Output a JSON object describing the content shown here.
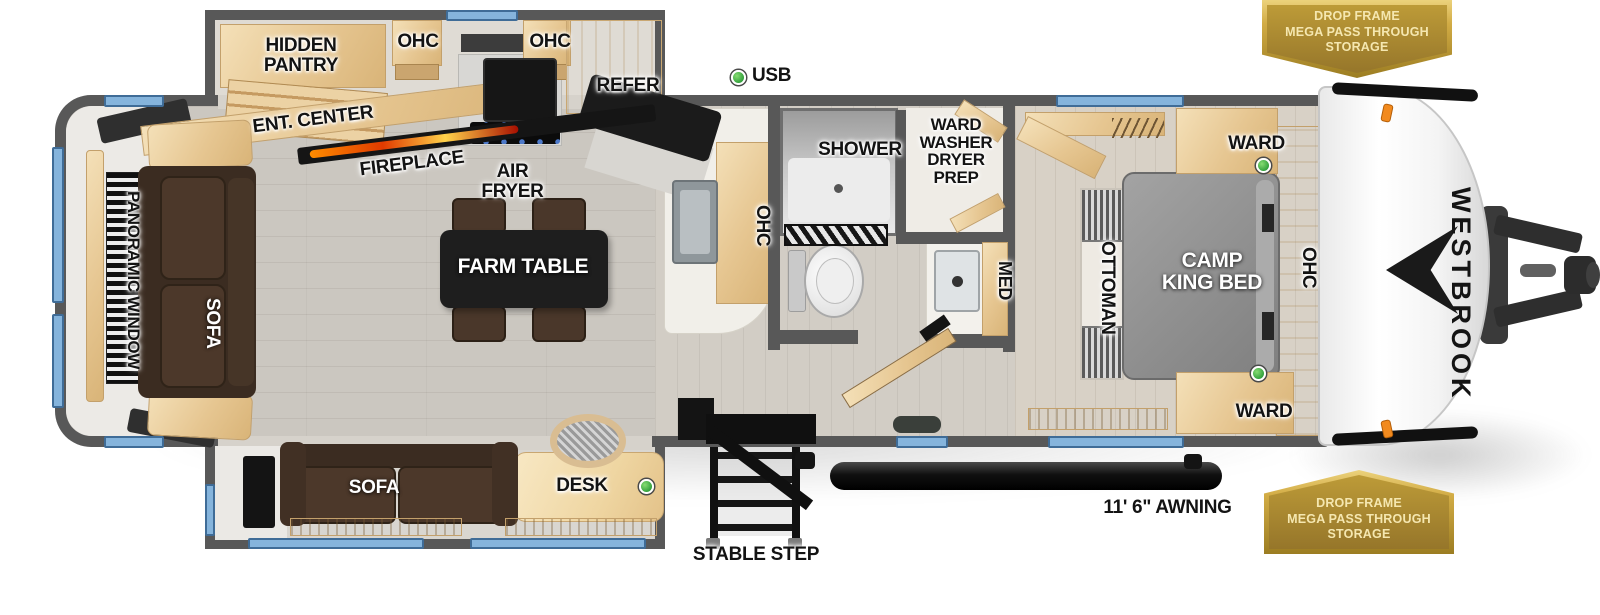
{
  "brand": {
    "name": "WESTBROOK"
  },
  "badges": {
    "top_right": {
      "lines": [
        "DROP FRAME",
        "MEGA PASS THROUGH",
        "STORAGE"
      ]
    },
    "bottom_right": {
      "lines": [
        "DROP FRAME",
        "MEGA PASS THROUGH",
        "STORAGE"
      ]
    }
  },
  "labels": {
    "hidden_pantry": "HIDDEN\nPANTRY",
    "ohc_kitchen_left": "OHC",
    "ohc_kitchen_right": "OHC",
    "refer": "REFER",
    "usb": "USB",
    "ent_center": "ENT. CENTER",
    "fireplace": "FIREPLACE",
    "air_fryer": "AIR\nFRYER",
    "panoramic_window": "PANORAMIC WINDOW",
    "sofa_rear": "SOFA",
    "farm_table": "FARM TABLE",
    "ohc_island": "OHC",
    "shower": "SHOWER",
    "ward_washer_dryer_prep": "WARD\nWASHER\nDRYER\nPREP",
    "med": "MED",
    "ottoman": "OTTOMAN",
    "camp_king_bed": "CAMP\nKING BED",
    "ward_front_top": "WARD",
    "ward_front_bottom": "WARD",
    "ohc_bedroom": "OHC",
    "sofa_slideout": "SOFA",
    "desk": "DESK",
    "stable_step": "STABLE STEP",
    "awning_length": "11' 6\" AWNING"
  },
  "indicators": {
    "usb_led": "green",
    "ward_top_led": "green",
    "ward_bottom_led": "green",
    "desk_led": "green"
  },
  "palette": {
    "wall": "#585858",
    "floor": "#cbc7c0",
    "wood": "#ecd2a6",
    "sofa_brown": "#4a3628",
    "bed_gray": "#8f8f8f",
    "table_black": "#1e1e1e",
    "window_blue": "#85b4dc",
    "badge_gold": "#b3922f",
    "badge_border": "#e9cf7c",
    "badge_text": "#f5e7b0",
    "led_green": "#35a844",
    "marker_orange": "#f28a1e"
  }
}
